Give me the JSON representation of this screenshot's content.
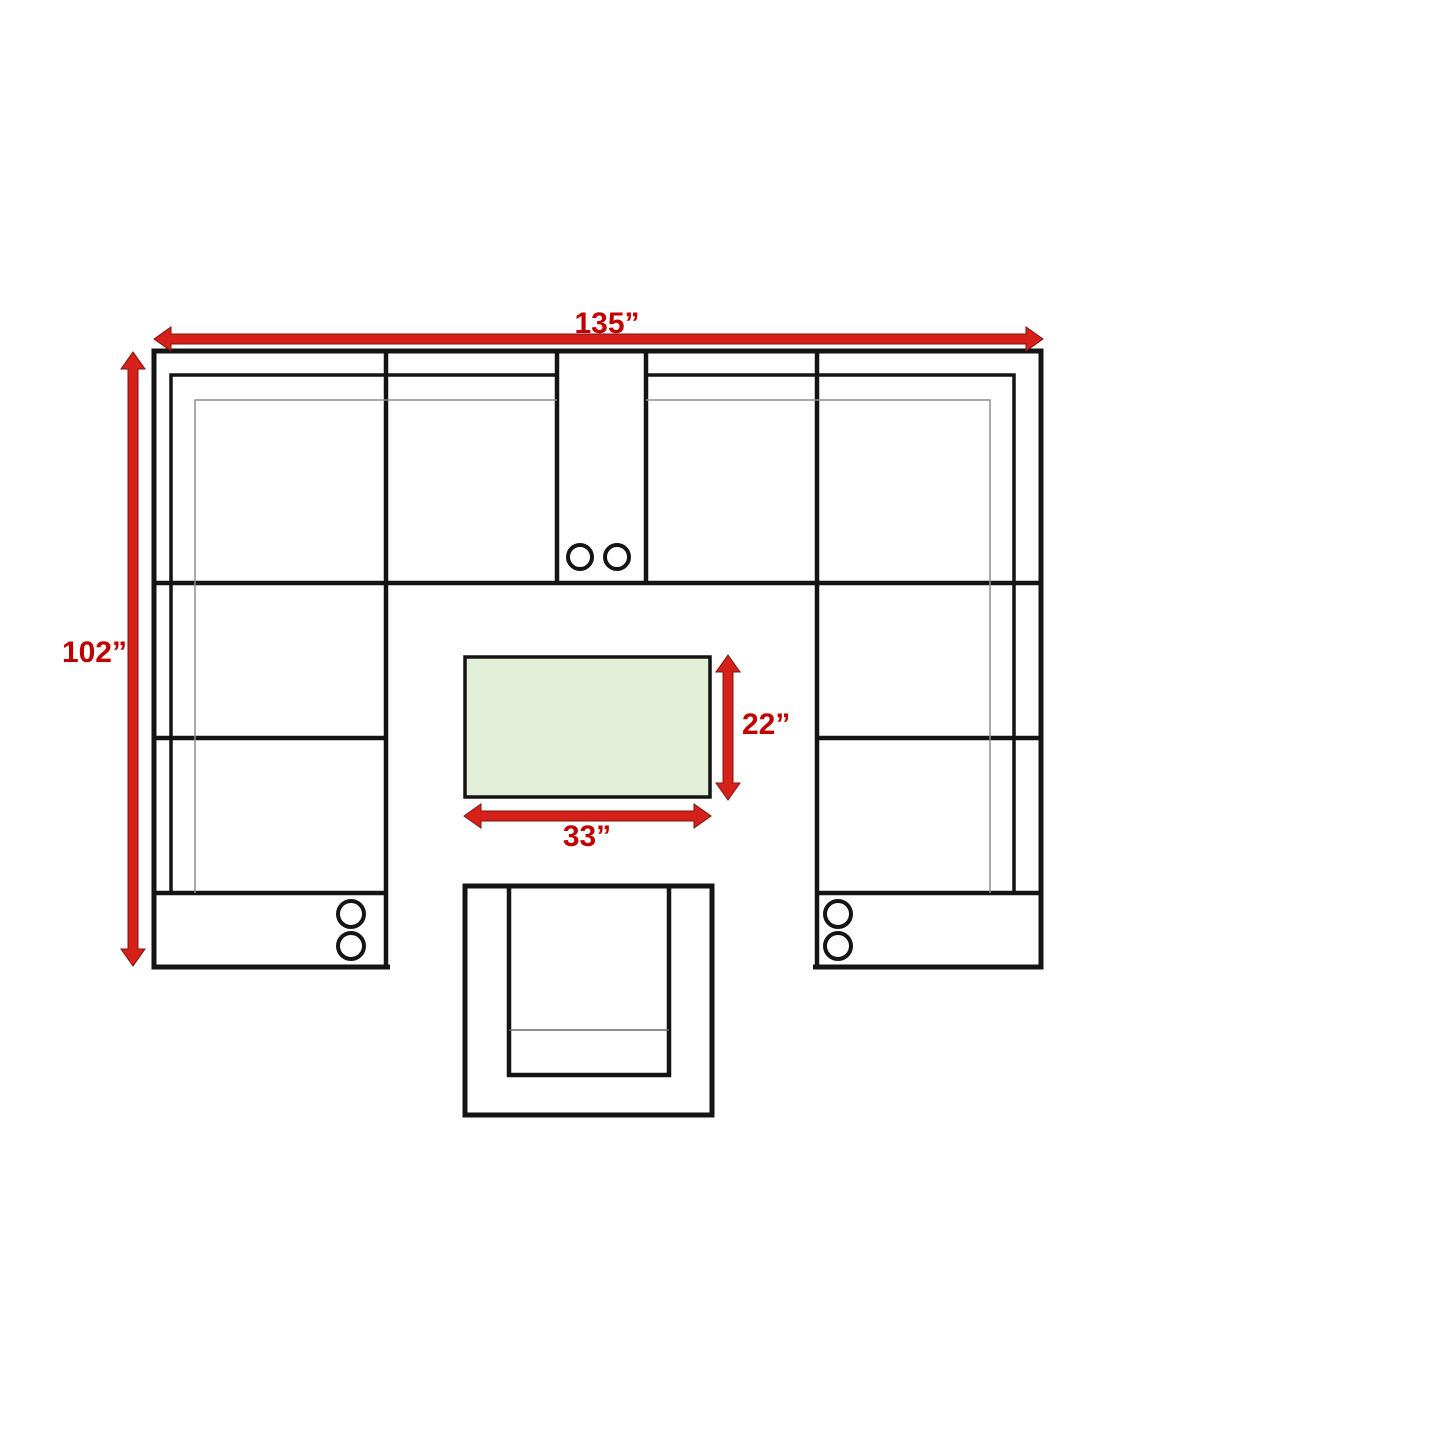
{
  "diagram": {
    "type": "furniture-dimension-plan",
    "background": "#ffffff",
    "dimension_labels": {
      "sectional_width": "135”",
      "sectional_depth": "102”",
      "table_depth": "22”",
      "table_width": "33”"
    },
    "dimension_values_inches": {
      "sectional_width": 135,
      "sectional_depth": 102,
      "table_depth": 22,
      "table_width": 33
    },
    "colors": {
      "dimension_text": "#c00000",
      "arrow_fill": "#d6211a",
      "arrow_outline": "#7e1410",
      "outline_black": "#141414",
      "seam_gray": "#8e8e8e",
      "table_fill": "#e2eed8",
      "white": "#ffffff"
    },
    "components": {
      "sectional": "u-shaped-sectional",
      "top_console": "console-2-cupholders",
      "left_console": "console-2-cupholders",
      "right_console": "console-2-cupholders",
      "coffee_table": "rectangular-coffee-table",
      "armchair": "armchair"
    }
  }
}
